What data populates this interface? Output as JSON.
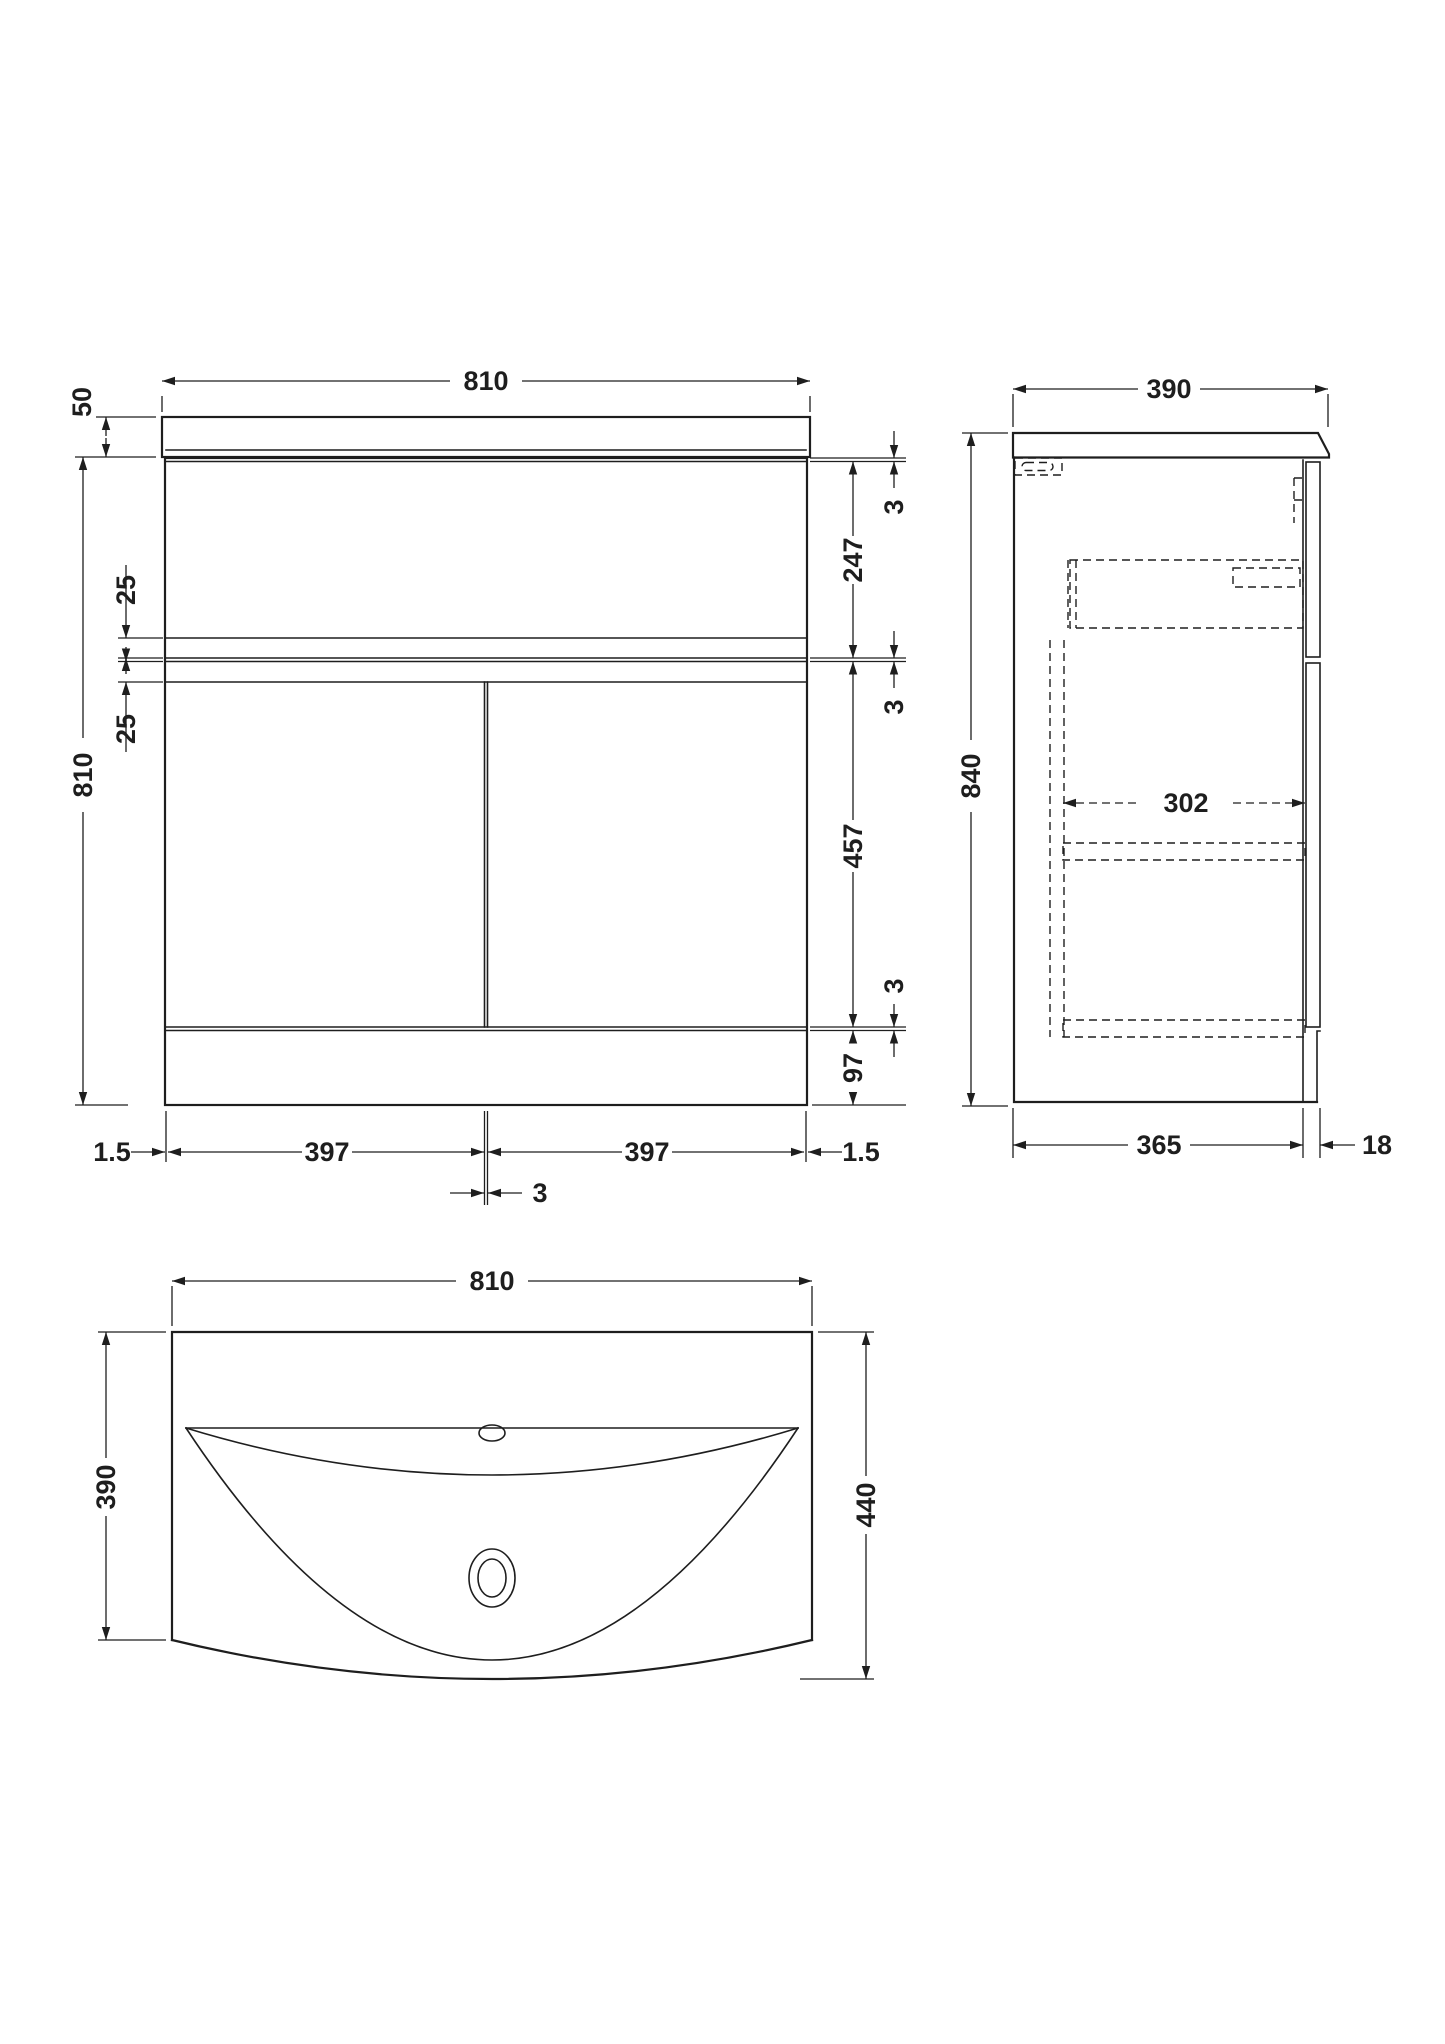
{
  "drawing_type": "bathroom-vanity-unit-technical-drawing",
  "style": {
    "line_color": "#1e1e1e",
    "background": "#ffffff"
  },
  "views": {
    "front": {
      "label": "front-elevation",
      "dims": {
        "width": "810",
        "basin_height": "50",
        "height": "810",
        "rail_upper": "25",
        "rail_lower": "25",
        "gap_top": "3",
        "drawer_front": "247",
        "gap_mid": "3",
        "doors_height": "457",
        "gap_bottom": "3",
        "plinth": "97",
        "inset_left": "1.5",
        "door_left": "397",
        "door_gap": "3",
        "door_right": "397",
        "inset_right": "1.5"
      }
    },
    "side": {
      "label": "side-elevation",
      "dims": {
        "depth": "390",
        "height": "840",
        "internal_depth": "302",
        "carcass_depth": "365",
        "front_thickness": "18"
      }
    },
    "plan": {
      "label": "plan-view-basin",
      "dims": {
        "width": "810",
        "depth_side": "390",
        "depth_total": "440"
      }
    }
  }
}
